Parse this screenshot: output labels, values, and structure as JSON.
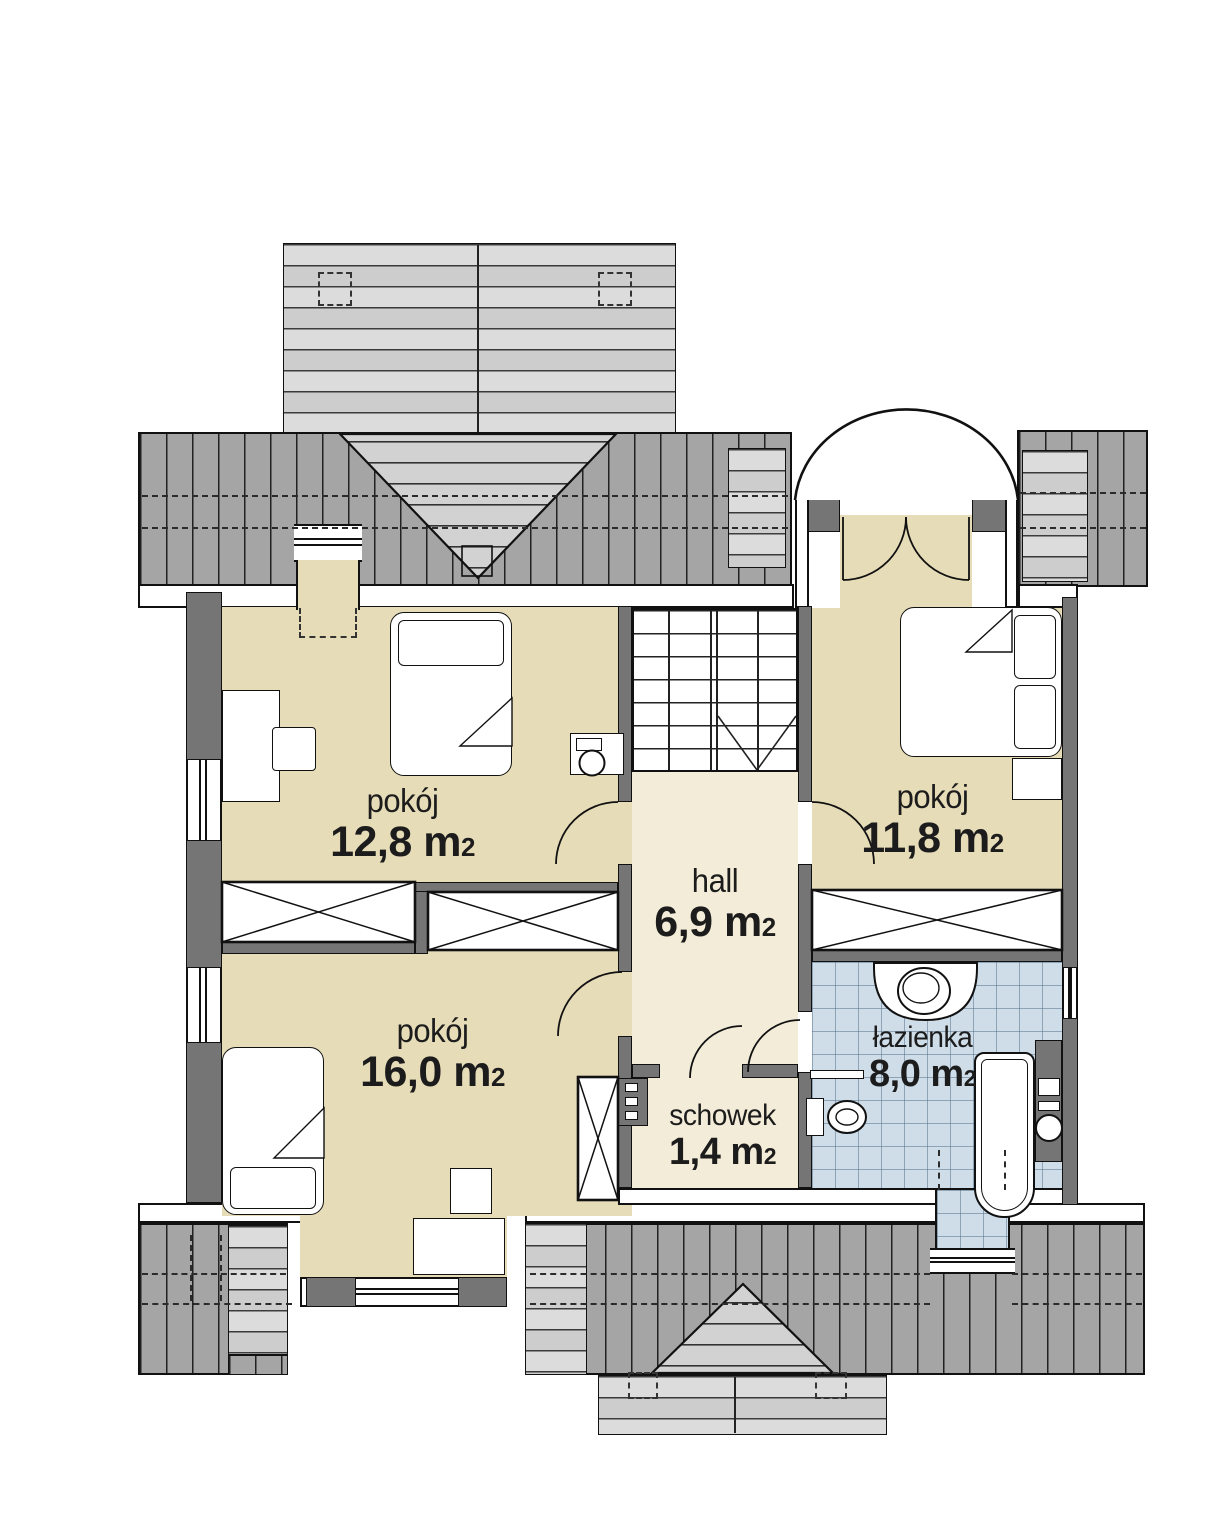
{
  "document": {
    "type": "architectural-floor-plan",
    "language": "pl"
  },
  "rooms": [
    {
      "key": "pokoj-top-left",
      "name": "pokój",
      "area": "12,8 m",
      "area_sup": "2"
    },
    {
      "key": "pokoj-top-right",
      "name": "pokój",
      "area": "11,8 m",
      "area_sup": "2"
    },
    {
      "key": "hall",
      "name": "hall",
      "area": "6,9 m",
      "area_sup": "2"
    },
    {
      "key": "pokoj-bottom",
      "name": "pokój",
      "area": "16,0 m",
      "area_sup": "2"
    },
    {
      "key": "schowek",
      "name": "schowek",
      "area": "1,4 m",
      "area_sup": "2"
    },
    {
      "key": "lazienka",
      "name": "łazienka",
      "area": "8,0 m",
      "area_sup": "2"
    }
  ],
  "colors": {
    "room-fill": "#e7dcb8",
    "hall-fill": "#f3ecd8",
    "tile-fill": "#cfdde9",
    "roof-dark": "#a5a5a5",
    "roof-light": "#d6d6d6",
    "wall-fill": "#757575",
    "line": "#111111",
    "text": "#1c1c1c"
  }
}
